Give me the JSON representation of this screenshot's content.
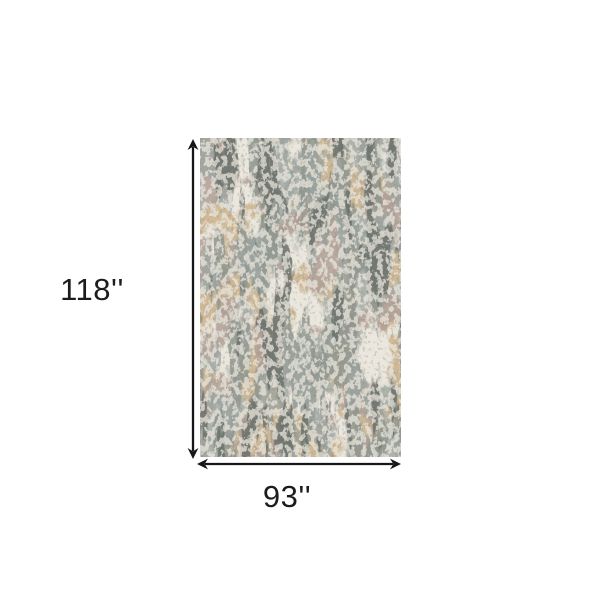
{
  "page": {
    "background": "#ffffff"
  },
  "diagram": {
    "height_label": "118''",
    "width_label": "93''",
    "text_color": "#1c1c1c",
    "arrow_color": "#161616"
  },
  "rug": {
    "palette": {
      "base": "#ebe7de",
      "gray_light": "#a8aea7",
      "gray_mid": "#8f968f",
      "gray_dark": "#6a706b",
      "tan": "#d0b894",
      "mauve": "#b2a096",
      "blue_gray": "#9ea6a2",
      "erosion": "#eae6dc",
      "speckle": "#8a9089"
    }
  }
}
